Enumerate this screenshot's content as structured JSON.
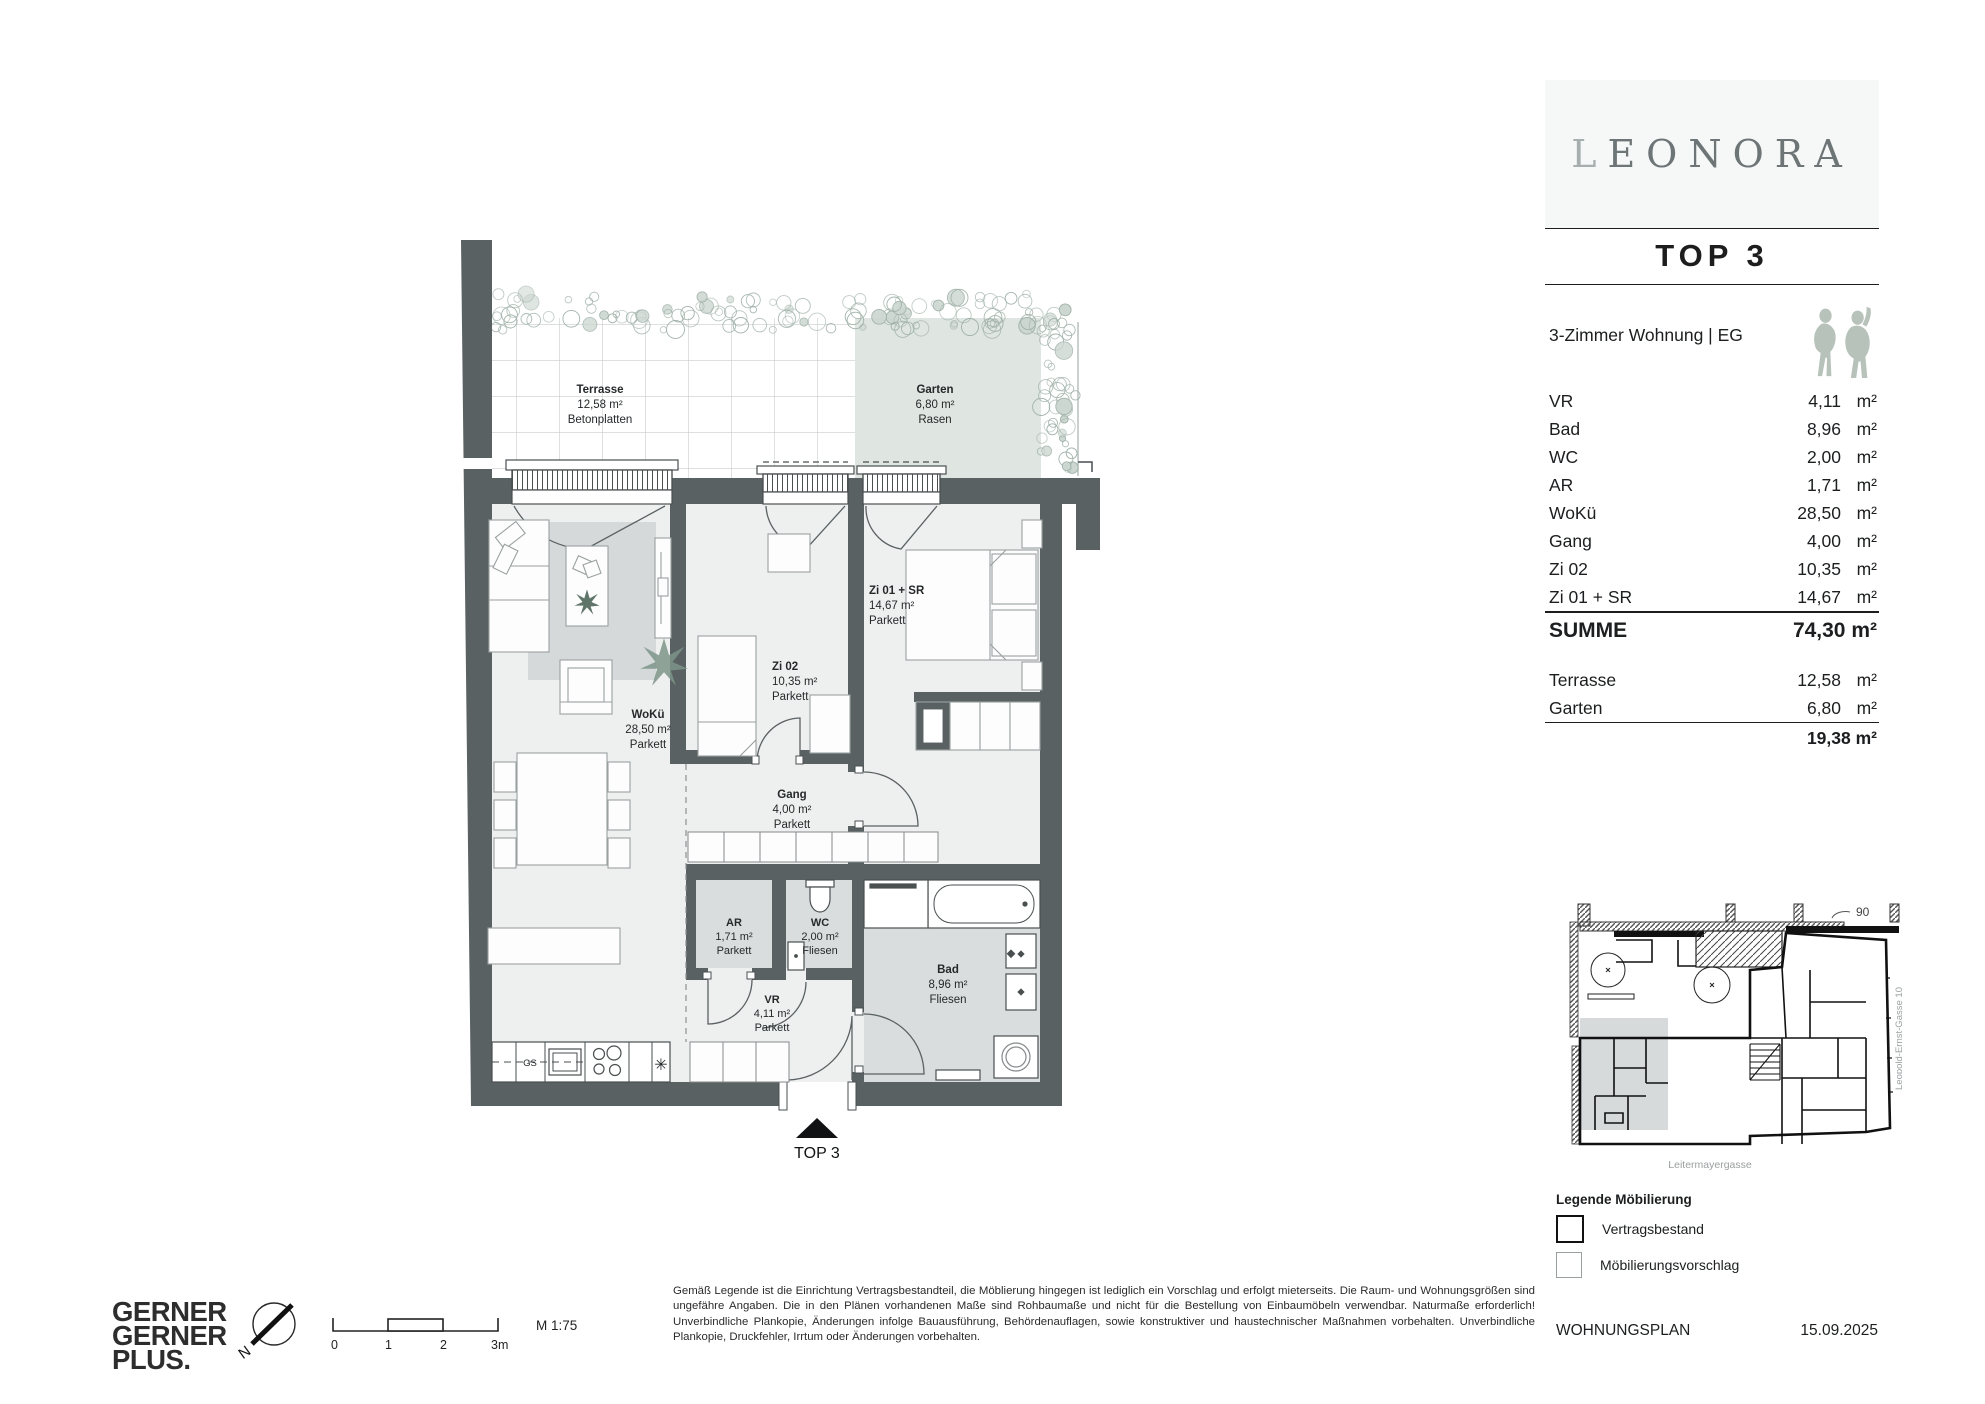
{
  "colors": {
    "wall": "#5a6162",
    "floor": "#eef0f0",
    "tile": "#d9dddd",
    "rug": "#d5d9d9",
    "garden": "#dfe5e1",
    "sage": "#b7c2bb",
    "accent_red": "#c00000"
  },
  "brand": {
    "logo": "LEONORA",
    "unit_title": "TOP 3"
  },
  "panel": {
    "type_line": "3-Zimmer Wohnung | EG",
    "rows": [
      {
        "label": "VR",
        "value": "4,11",
        "unit": "m²"
      },
      {
        "label": "Bad",
        "value": "8,96",
        "unit": "m²"
      },
      {
        "label": "WC",
        "value": "2,00",
        "unit": "m²"
      },
      {
        "label": "AR",
        "value": "1,71",
        "unit": "m²"
      },
      {
        "label": "WoKü",
        "value": "28,50",
        "unit": "m²"
      },
      {
        "label": "Gang",
        "value": "4,00",
        "unit": "m²"
      },
      {
        "label": "Zi 02",
        "value": "10,35",
        "unit": "m²"
      },
      {
        "label": "Zi 01 + SR",
        "value": "14,67",
        "unit": "m²"
      }
    ],
    "summe_label": "SUMME",
    "summe_value": "74,30 m²",
    "outdoor": [
      {
        "label": "Terrasse",
        "value": "12,58",
        "unit": "m²"
      },
      {
        "label": "Garten",
        "value": "6,80",
        "unit": "m²"
      }
    ],
    "outdoor_total": "19,38 m²"
  },
  "plan": {
    "rooms": {
      "wokue": {
        "name": "WoKü",
        "area": "28,50 m²",
        "floor": "Parkett"
      },
      "zi02": {
        "name": "Zi 02",
        "area": "10,35 m²",
        "floor": "Parkett"
      },
      "zi01": {
        "name": "Zi 01 + SR",
        "area": "14,67 m²",
        "floor": "Parkett"
      },
      "gang": {
        "name": "Gang",
        "area": "4,00 m²",
        "floor": "Parkett"
      },
      "ar": {
        "name": "AR",
        "area": "1,71 m²",
        "floor": "Parkett"
      },
      "wc": {
        "name": "WC",
        "area": "2,00 m²",
        "floor": "Fliesen"
      },
      "bad": {
        "name": "Bad",
        "area": "8,96 m²",
        "floor": "Fliesen"
      },
      "vr": {
        "name": "VR",
        "area": "4,11 m²",
        "floor": "Parkett"
      },
      "terrasse": {
        "name": "Terrasse",
        "area": "12,58 m²",
        "floor": "Betonplatten"
      },
      "garten": {
        "name": "Garten",
        "area": "6,80 m²",
        "floor": "Rasen"
      }
    },
    "entrance_label": "TOP 3",
    "kitchen_dishwasher": "GS"
  },
  "site": {
    "street_bottom": "Leitermayergasse",
    "street_right": "Leopold-Ernst-Gasse 10",
    "number": "90"
  },
  "legend": {
    "title": "Legende Möbilierung",
    "items": [
      {
        "label": "Vertragsbestand"
      },
      {
        "label": "Möbilierungsvorschlag"
      }
    ]
  },
  "footer": {
    "company_lines": [
      "GERNER",
      "GERNER",
      "PLUS."
    ],
    "north": "N",
    "scale_ticks": [
      "0",
      "1",
      "2",
      "3m"
    ],
    "scale_label": "M 1:75",
    "doc_type": "WOHNUNGSPLAN",
    "date": "15.09.2025",
    "disclaimer": "Gemäß Legende ist die Einrichtung Vertragsbestandteil, die Möblierung hingegen ist lediglich ein Vorschlag und erfolgt mieterseits. Die Raum- und Wohnungsgrößen sind ungefähre Angaben. Die in den Plänen vorhandenen Maße sind Rohbaumaße und nicht für die Bestellung von Einbaumöbeln verwendbar. Naturmaße erforderlich! Unverbindliche Plankopie, Änderungen infolge Bauausführung, Behördenauflagen, sowie konstruktiver und haustechnischer Maßnahmen vorbehalten. Unverbindliche Plankopie, Druckfehler, Irrtum oder Änderungen vorbehalten."
  }
}
